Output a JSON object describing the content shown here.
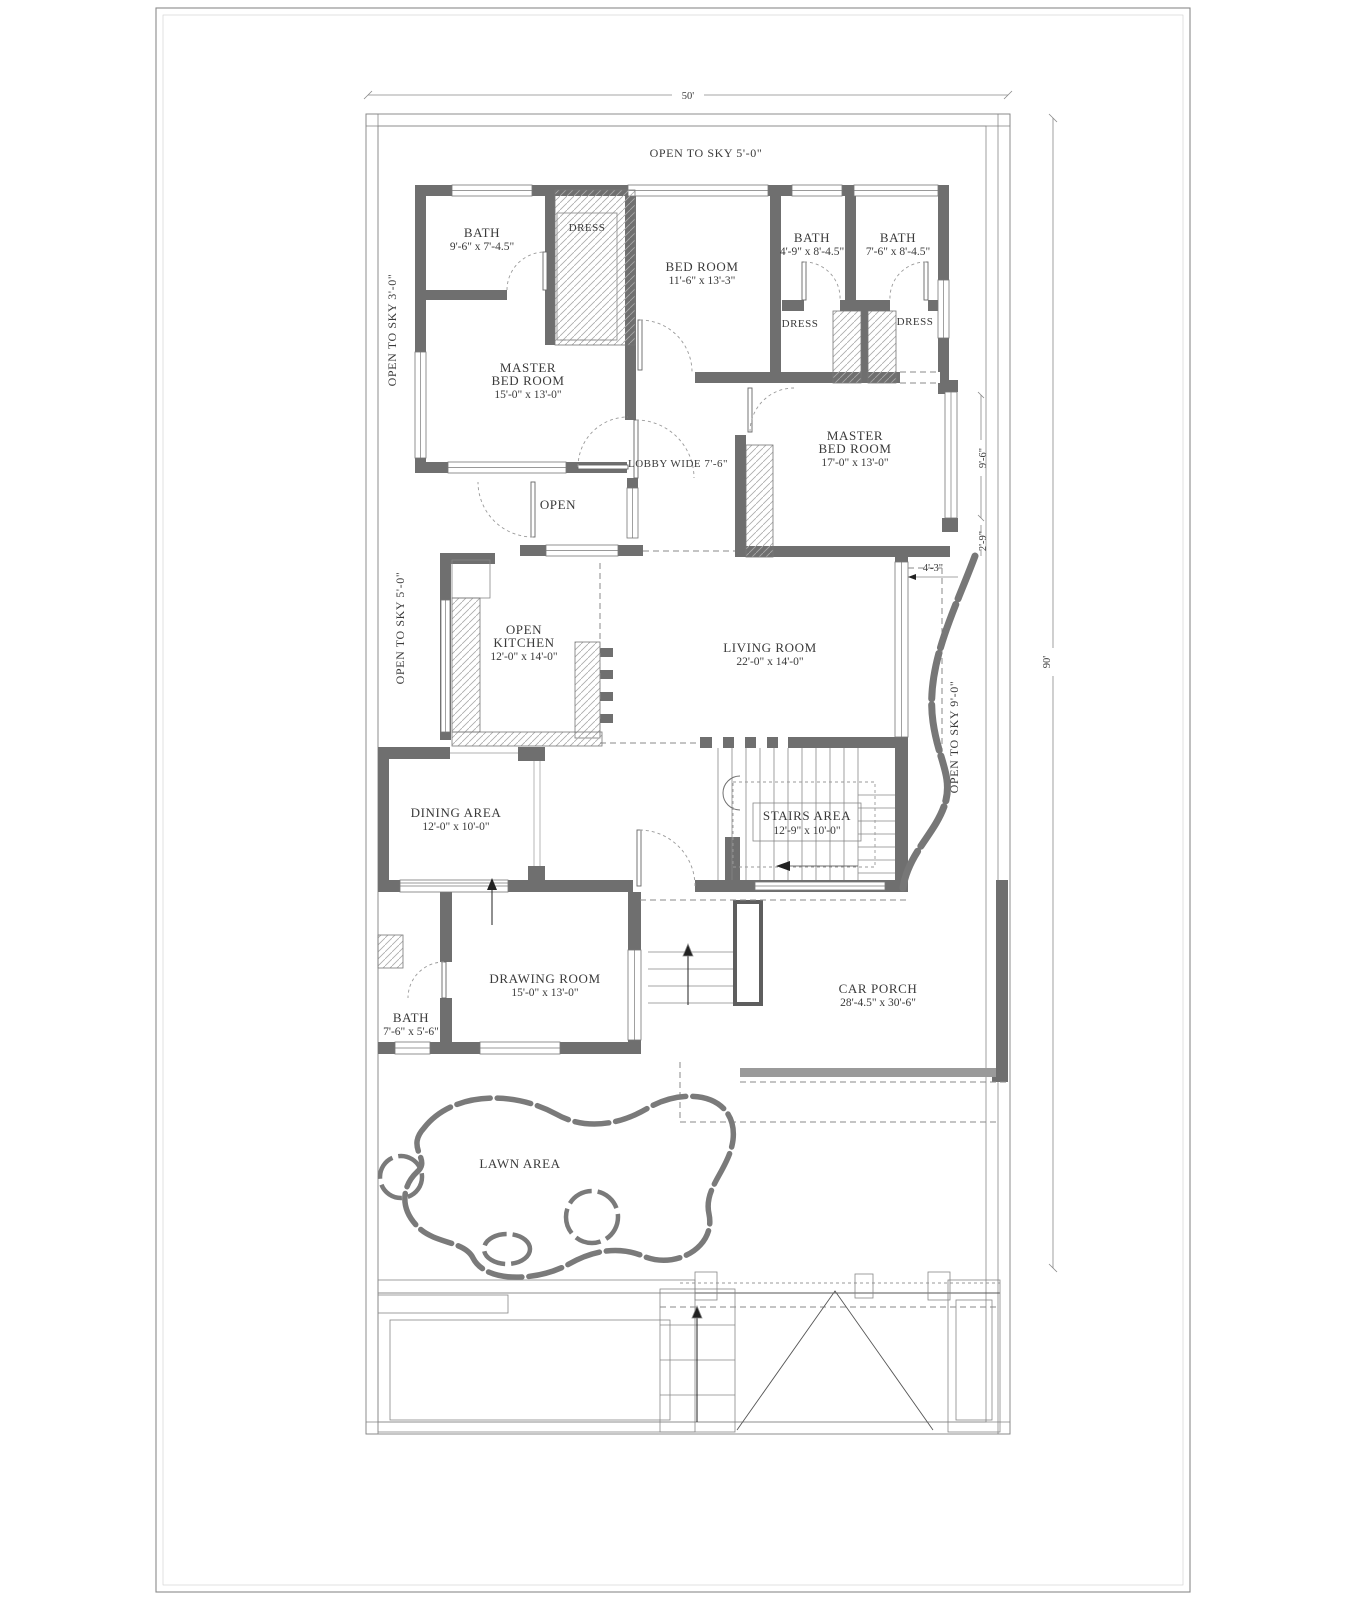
{
  "plan": {
    "overall_width": "50'",
    "overall_height": "90'"
  },
  "annotations": {
    "open_to_sky_top": "OPEN TO SKY 5'-0\"",
    "open_to_sky_left_upper": "OPEN TO SKY 3'-0\"",
    "open_to_sky_left_lower": "OPEN TO SKY 5'-0\"",
    "open_to_sky_right": "OPEN TO SKY 9'-0\""
  },
  "dims": {
    "d_4_3": "4'-3\"",
    "d_9_6": "9'-6\"",
    "d_2_9": "2'-9\""
  },
  "rooms": {
    "bath_top_left": {
      "name": "BATH",
      "dims": "9'-6\" x 7'-4.5\""
    },
    "dress_top_left": {
      "name": "DRESS"
    },
    "bed_room": {
      "name": "BED ROOM",
      "dims": "11'-6\" x 13'-3\""
    },
    "bath_mid": {
      "name": "BATH",
      "dims": "4'-9\" x 8'-4.5\""
    },
    "bath_right": {
      "name": "BATH",
      "dims": "7'-6\" x 8'-4.5\""
    },
    "dress_mid": {
      "name": "DRESS"
    },
    "dress_right": {
      "name": "DRESS"
    },
    "master_bed_left": {
      "line1": "MASTER",
      "line2": "BED ROOM",
      "dims": "15'-0\" x 13'-0\""
    },
    "master_bed_right": {
      "line1": "MASTER",
      "line2": "BED ROOM",
      "dims": "17'-0\" x 13'-0\""
    },
    "lobby": {
      "name": "LOBBY WIDE 7'-6\""
    },
    "open_area": {
      "name": "OPEN"
    },
    "open_kitchen": {
      "line1": "OPEN",
      "line2": "KITCHEN",
      "dims": "12'-0\" x 14'-0\""
    },
    "living_room": {
      "name": "LIVING ROOM",
      "dims": "22'-0\" x 14'-0\""
    },
    "dining_area": {
      "name": "DINING AREA",
      "dims": "12'-0\" x 10'-0\""
    },
    "stairs_area": {
      "name": "STAIRS AREA",
      "dims": "12'-9\" x 10'-0\""
    },
    "drawing_room": {
      "name": "DRAWING ROOM",
      "dims": "15'-0\" x 13'-0\""
    },
    "bath_bottom": {
      "name": "BATH",
      "dims": "7'-6\" x 5'-6\""
    },
    "car_porch": {
      "name": "CAR PORCH",
      "dims": "28'-4.5\" x 30'-6\""
    },
    "lawn_area": {
      "name": "LAWN AREA"
    }
  },
  "colors": {
    "wall": "#6f6f6f",
    "line": "#777777",
    "hatch": "#aaaaaa",
    "text": "#3a3a3a",
    "paper": "#ffffff"
  }
}
